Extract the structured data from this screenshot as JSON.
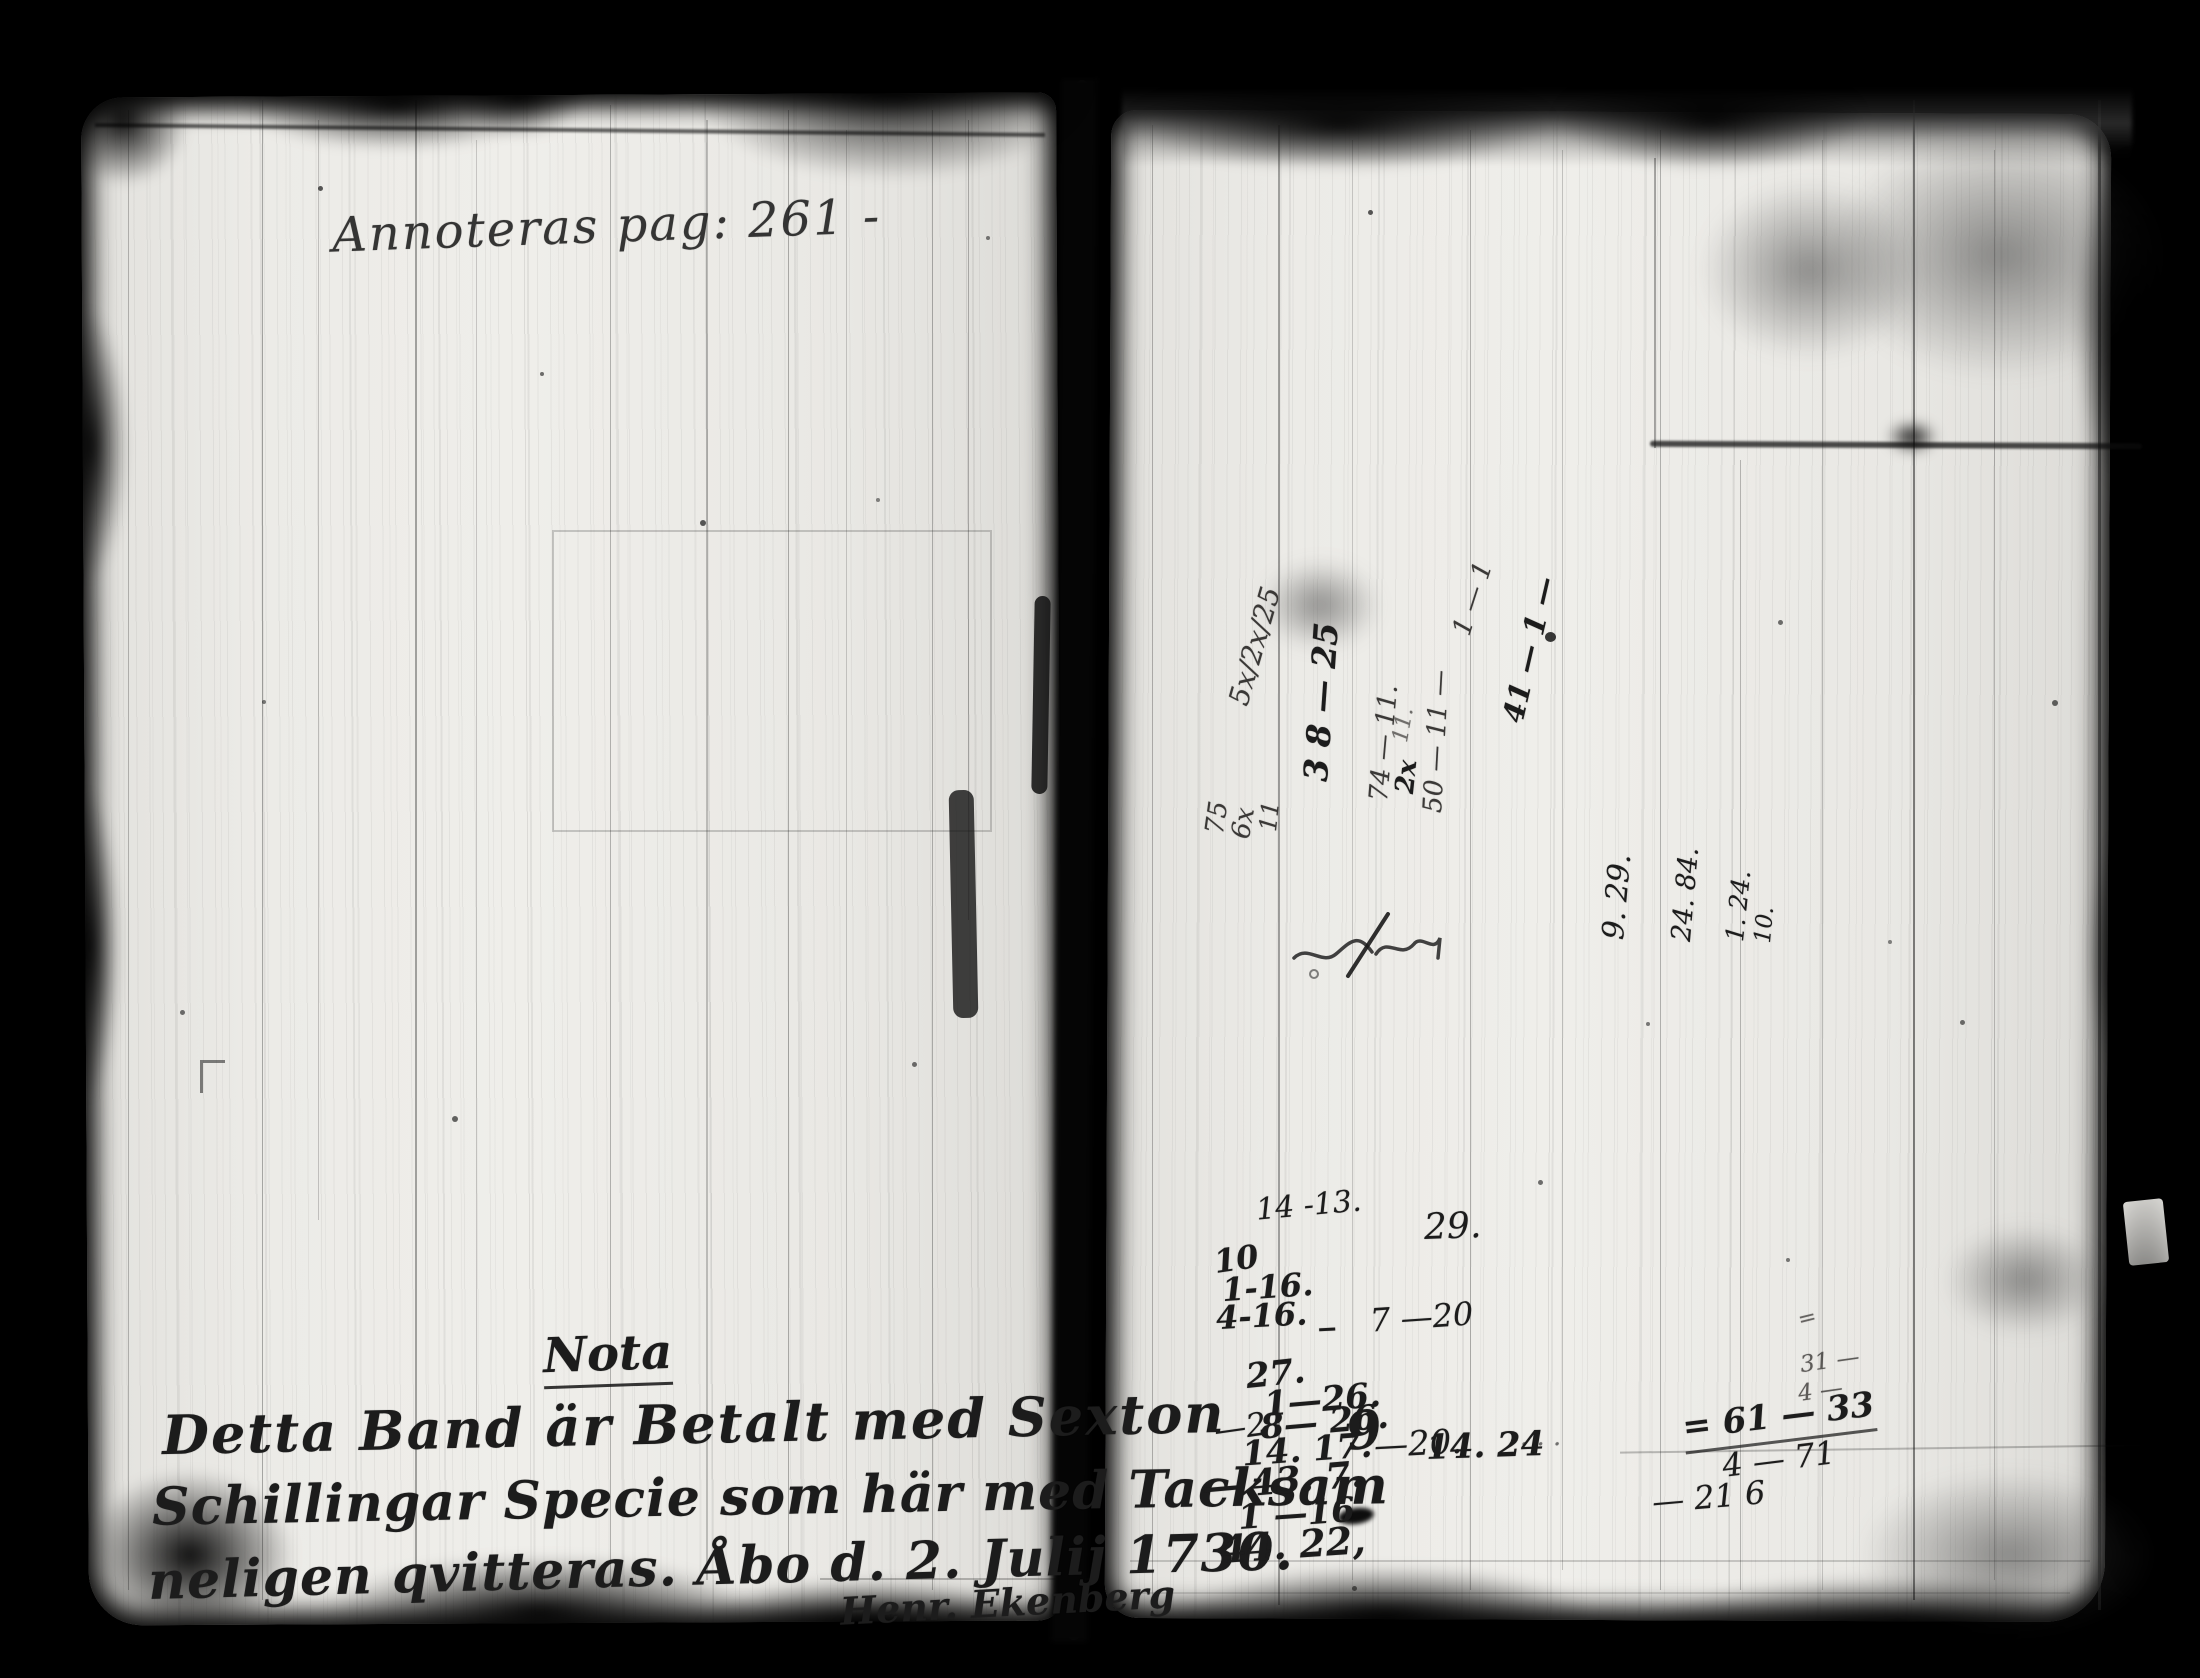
{
  "document": {
    "kind": "scanned archival manuscript spread",
    "colors": {
      "background": "#000000",
      "paper": "#eae9e5",
      "ink": "#1c1c1c",
      "pencil": "#3a3836"
    },
    "left_page": {
      "page_note": "Annoteras pag: 261 -",
      "nota_heading": "Nota",
      "nota_line1": "Detta Band är Betalt med Sexton",
      "nota_line2": "Schillingar Specie som här med Tacksam",
      "nota_line3": "neligen qvitteras. Åbo d. 2. Julij 1730.",
      "signature": "Henr. Ekenberg"
    },
    "right_page": {
      "rotated_jottings": {
        "r1": "75",
        "r2": "6x",
        "r3": "11",
        "r4": "5x/2x/25",
        "r5": "3 8 — 25",
        "r6": "74 — 11.",
        "r7": "2x",
        "r8": "50 — 11 —",
        "r9": "41 — 1 —",
        "r10": "1 — 1",
        "r11": "11.",
        "r12": "9. 29.",
        "r13": "24. 84.",
        "r14": "1. 24.",
        "r15": "10."
      },
      "number_jottings": {
        "n1": "14 -13.",
        "n2": "29.",
        "n3": "10",
        "n4": "1-16.",
        "n5": "4-16. _",
        "n6": "7 —20",
        "n7": "27.",
        "n8": "1—26.",
        "n9": "—2",
        "n10": "8— 26.",
        "n11": "9",
        "n12": "14. 17.",
        "n13": "—20.",
        "n14": "14. 24",
        "n15": "· · ·",
        "n16": "— 43. 7.",
        "n17": "1 —16",
        "n18": "44. 22,"
      },
      "sum_jottings": {
        "s1": "=",
        "s2": "31 —",
        "s3": "4 —",
        "s4": "= 61 — 33",
        "s5": "4 — 71",
        "s6": "— 21 6"
      }
    }
  }
}
